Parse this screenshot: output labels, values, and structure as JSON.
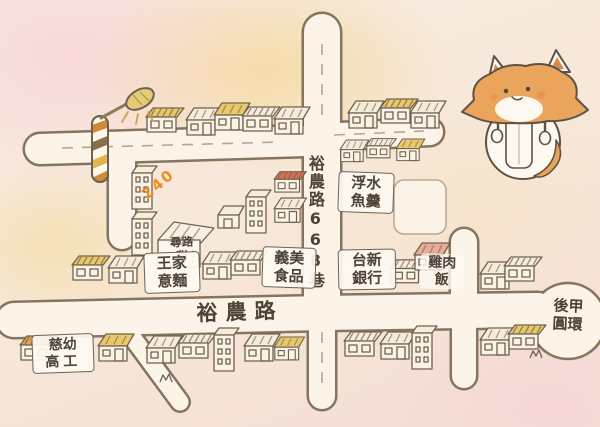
{
  "map": {
    "kind": "hand-drawn food map",
    "labels": {
      "lane668": "裕農路668巷",
      "main_road": "裕農路",
      "dessert_shop": {
        "line1": "尋路",
        "line2": "甜"
      },
      "wang_noodles": {
        "line1": "王家",
        "line2": "意麵"
      },
      "imei_foods": {
        "line1": "義美",
        "line2": "食品"
      },
      "taishin_bank": {
        "line1": "台新",
        "line2": "銀行"
      },
      "chicken_rice": {
        "line1": "雞肉",
        "line2": "飯"
      },
      "fish_soup": {
        "line1": "浮水",
        "line2": "魚羹"
      },
      "roundabout": {
        "line1": "後甲",
        "line2": "圓環"
      },
      "school": {
        "line1": "慈幼",
        "line2": "高工"
      },
      "house_number": "240"
    },
    "colors": {
      "paper": "#f7e7d8",
      "road_fill": "#fcf3e9",
      "ink": "#6f6150",
      "road_ink": "#85755f",
      "accent_orange": "#ef8c1e",
      "fox_orange": "#eaa45c",
      "roof_yellow": "#e8c868",
      "roof_red": "#d4704e"
    },
    "icons": [
      "street-lamp-icon",
      "fox-mascot-icon",
      "fork-icon",
      "spoon-icon"
    ]
  }
}
